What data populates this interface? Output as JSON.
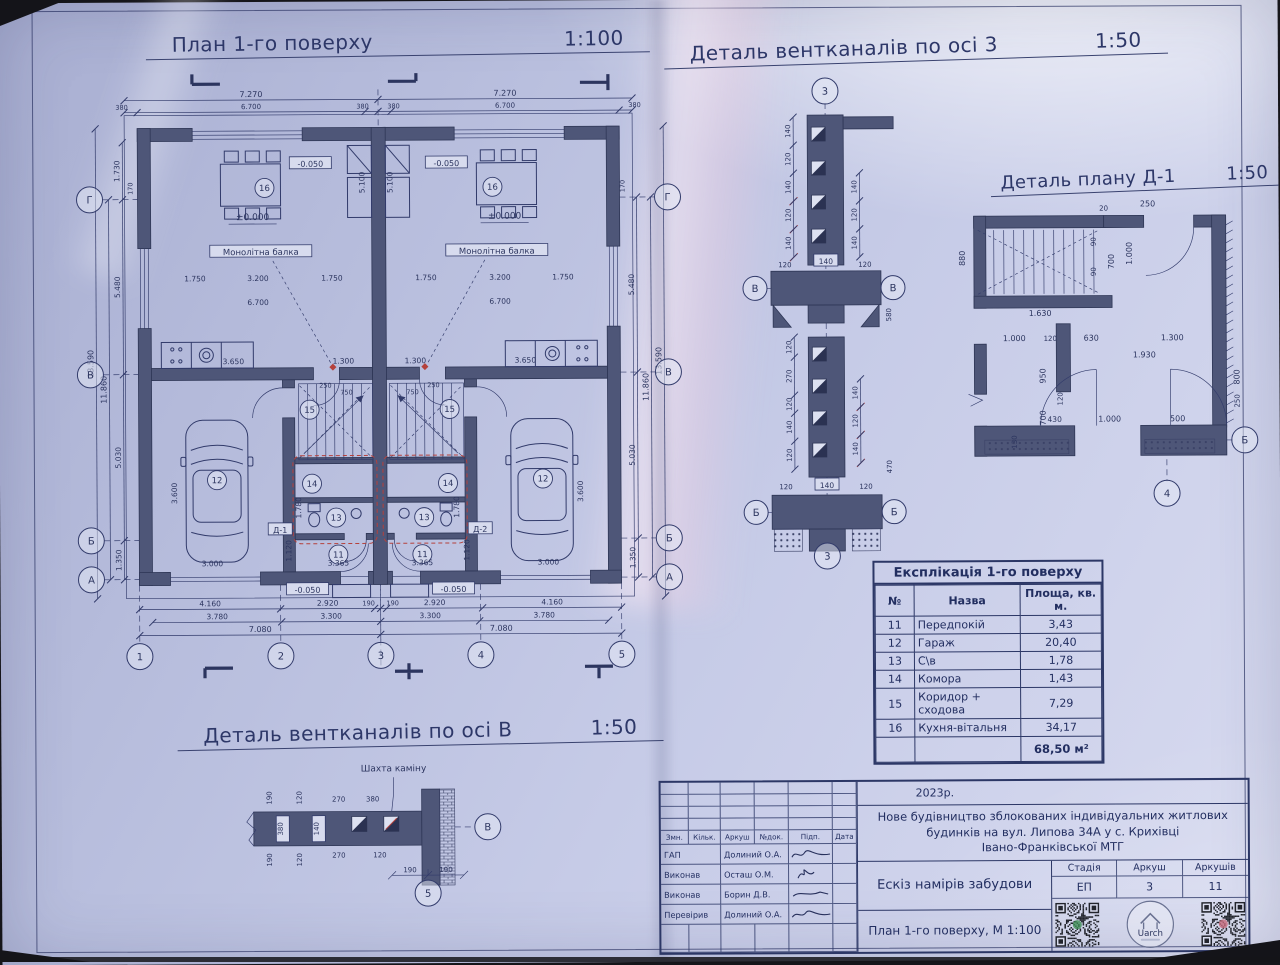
{
  "titles": {
    "plan": {
      "text": "План 1-го поверху",
      "scale": "1:100"
    },
    "vent3": {
      "text": "Деталь вентканалів по осі 3",
      "scale": "1:50"
    },
    "d1": {
      "text": "Деталь плану Д-1",
      "scale": "1:50"
    },
    "ventb": {
      "text": "Деталь вентканалів по осі В",
      "scale": "1:50"
    }
  },
  "colors": {
    "paper": "#c6cbe7",
    "ink": "#323b6b",
    "wall": "#4e5678",
    "red_mark": "#b5413c"
  },
  "plan": {
    "axes": {
      "left": [
        "Г",
        "В",
        "Б",
        "А"
      ],
      "right": [
        "Г",
        "В",
        "Б",
        "А"
      ],
      "bottom": [
        "1",
        "2",
        "3",
        "4",
        "5"
      ]
    },
    "rooms": [
      "11",
      "12",
      "13",
      "14",
      "15",
      "16"
    ],
    "levels": {
      "zero": "±0.000",
      "minus": "-0.050"
    },
    "beam": "Монолітна балка",
    "details": [
      "Д-1",
      "Д-2"
    ],
    "dims": {
      "top1": [
        "7.270",
        "7.270"
      ],
      "top2": [
        "380",
        "6.700",
        "380",
        "380",
        "6.700",
        "380"
      ],
      "left1": [
        "1.730",
        "5.480",
        "5.030",
        "1.350"
      ],
      "left2": [
        "11.860"
      ],
      "left3": [
        "13.590"
      ],
      "right1": [
        "5.480",
        "5.030",
        "1.350"
      ],
      "right2": [
        "11.860"
      ],
      "right3": [
        "13.590"
      ],
      "bottom1": [
        "4.160",
        "2.920",
        "190",
        "190",
        "2.920",
        "4.160"
      ],
      "bottom2": [
        "3.780",
        "3.300",
        "3.300",
        "3.780"
      ],
      "bottom3": [
        "7.080",
        "7.080"
      ],
      "axis_off": [
        "170",
        "170"
      ],
      "inner": [
        "1.750",
        "3.200",
        "1.750",
        "6.700",
        "3.650",
        "1.300",
        "3.600",
        "3.000",
        "3.365",
        "1.780",
        "1.120",
        "5.100",
        "750",
        "250"
      ]
    }
  },
  "vent3": {
    "axes": {
      "top": "3",
      "mid": "В",
      "low": "Б",
      "bottom": "3"
    },
    "box": "140",
    "left_top": [
      "140",
      "120",
      "140",
      "120",
      "140"
    ],
    "right_top": [
      "140",
      "120",
      "140"
    ],
    "cross_top": [
      "120",
      "120"
    ],
    "v580": "580",
    "left_low": [
      "120",
      "270",
      "120",
      "140",
      "120"
    ],
    "right_low": [
      "140",
      "120",
      "140"
    ],
    "cross_low": [
      "120",
      "120"
    ],
    "v470": "470"
  },
  "d1": {
    "axes": {
      "right": "Б",
      "bottom": "4"
    },
    "dims": [
      "20",
      "250",
      "880",
      "90",
      "90",
      "700",
      "1.000",
      "1.630",
      "1.000",
      "120",
      "630",
      "1.300",
      "1.930",
      "950",
      "120",
      "700",
      "430",
      "1.000",
      "500",
      "130",
      "250",
      "800"
    ]
  },
  "ventb": {
    "label": "Шахта каміну",
    "axes": {
      "right": "В",
      "bottom": "5"
    },
    "box1": "380",
    "box2": "140",
    "dims": [
      "190",
      "120",
      "190",
      "120",
      "270",
      "380",
      "270",
      "120",
      "190",
      "190"
    ]
  },
  "table": {
    "title": "Експлікація 1-го поверху",
    "headers": [
      "№",
      "Назва",
      "Площа, кв. м."
    ],
    "rows": [
      [
        "11",
        "Передпокій",
        "3,43"
      ],
      [
        "12",
        "Гараж",
        "20,40"
      ],
      [
        "13",
        "С\\в",
        "1,78"
      ],
      [
        "14",
        "Комора",
        "1,43"
      ],
      [
        "15",
        "Коридор + сходова",
        "7,29"
      ],
      [
        "16",
        "Кухня-вітальня",
        "34,17"
      ]
    ],
    "total": "68,50 м²"
  },
  "titleblock": {
    "year": "2023р.",
    "project_lines": [
      "Нове будівництво зблокованих індивідуальних житлових",
      "будинків на вул. Липова 34А у с. Крихівці",
      "Івано-Франківської МТГ"
    ],
    "cols": [
      "Змн.",
      "Кільк.",
      "Аркуш",
      "№док.",
      "Підп.",
      "Дата"
    ],
    "people": [
      {
        "role": "ГАП",
        "name": "Долиний О.А."
      },
      {
        "role": "Виконав",
        "name": "Осташ О.М."
      },
      {
        "role": "Виконав",
        "name": "Борин Д.В."
      },
      {
        "role": "Перевірив",
        "name": "Долиний О.А."
      }
    ],
    "doc_title": "Ескіз намірів забудови",
    "stage_headers": [
      "Стадія",
      "Аркуш",
      "Аркушів"
    ],
    "stage_values": [
      "ЕП",
      "3",
      "11"
    ],
    "sheet_title": "План 1-го поверху, М 1:100",
    "logo_text": "Uarch"
  }
}
